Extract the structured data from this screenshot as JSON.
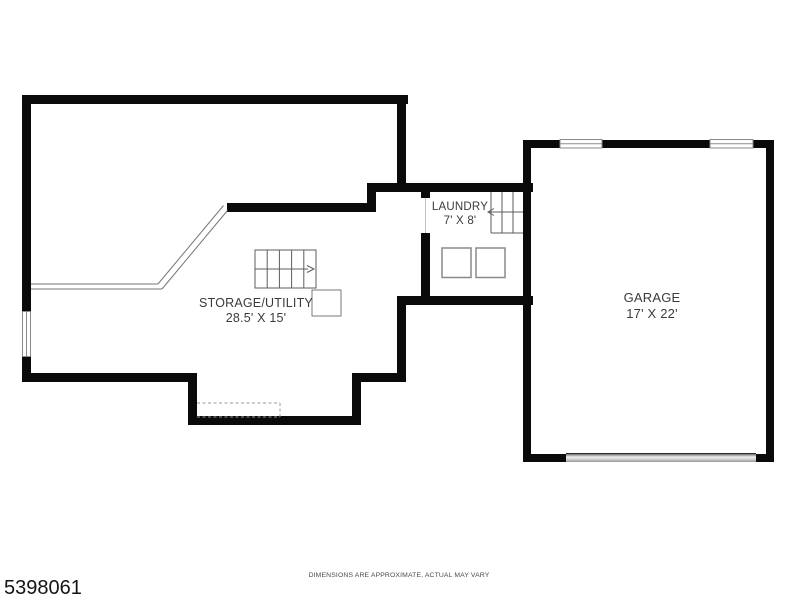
{
  "floorplan": {
    "title": "basement-and-garage-floor-plan",
    "rooms": [
      {
        "name": "STORAGE/UTILITY",
        "dimensions": "28.5' X 15'"
      },
      {
        "name": "LAUNDRY",
        "dimensions": "7' X 8'"
      },
      {
        "name": "GARAGE",
        "dimensions": "17' X 22'"
      }
    ],
    "features": [
      "staircase-with-up-arrow-right",
      "staircase-with-up-arrow-left",
      "washer-box",
      "dryer-box",
      "utility-square",
      "railing-half-wall-diagonal",
      "window-left-wall",
      "garage-window-1",
      "garage-window-2",
      "garage-door",
      "dashed-storage-area"
    ],
    "footer": {
      "listing_id": "5398061",
      "disclaimer": "DIMENSIONS ARE APPROXIMATE, ACTUAL MAY VARY"
    },
    "colors": {
      "wall": "#0a0a0a",
      "thin_line": "#6b6b6b",
      "text": "#3b3b3b",
      "background": "#ffffff"
    }
  }
}
